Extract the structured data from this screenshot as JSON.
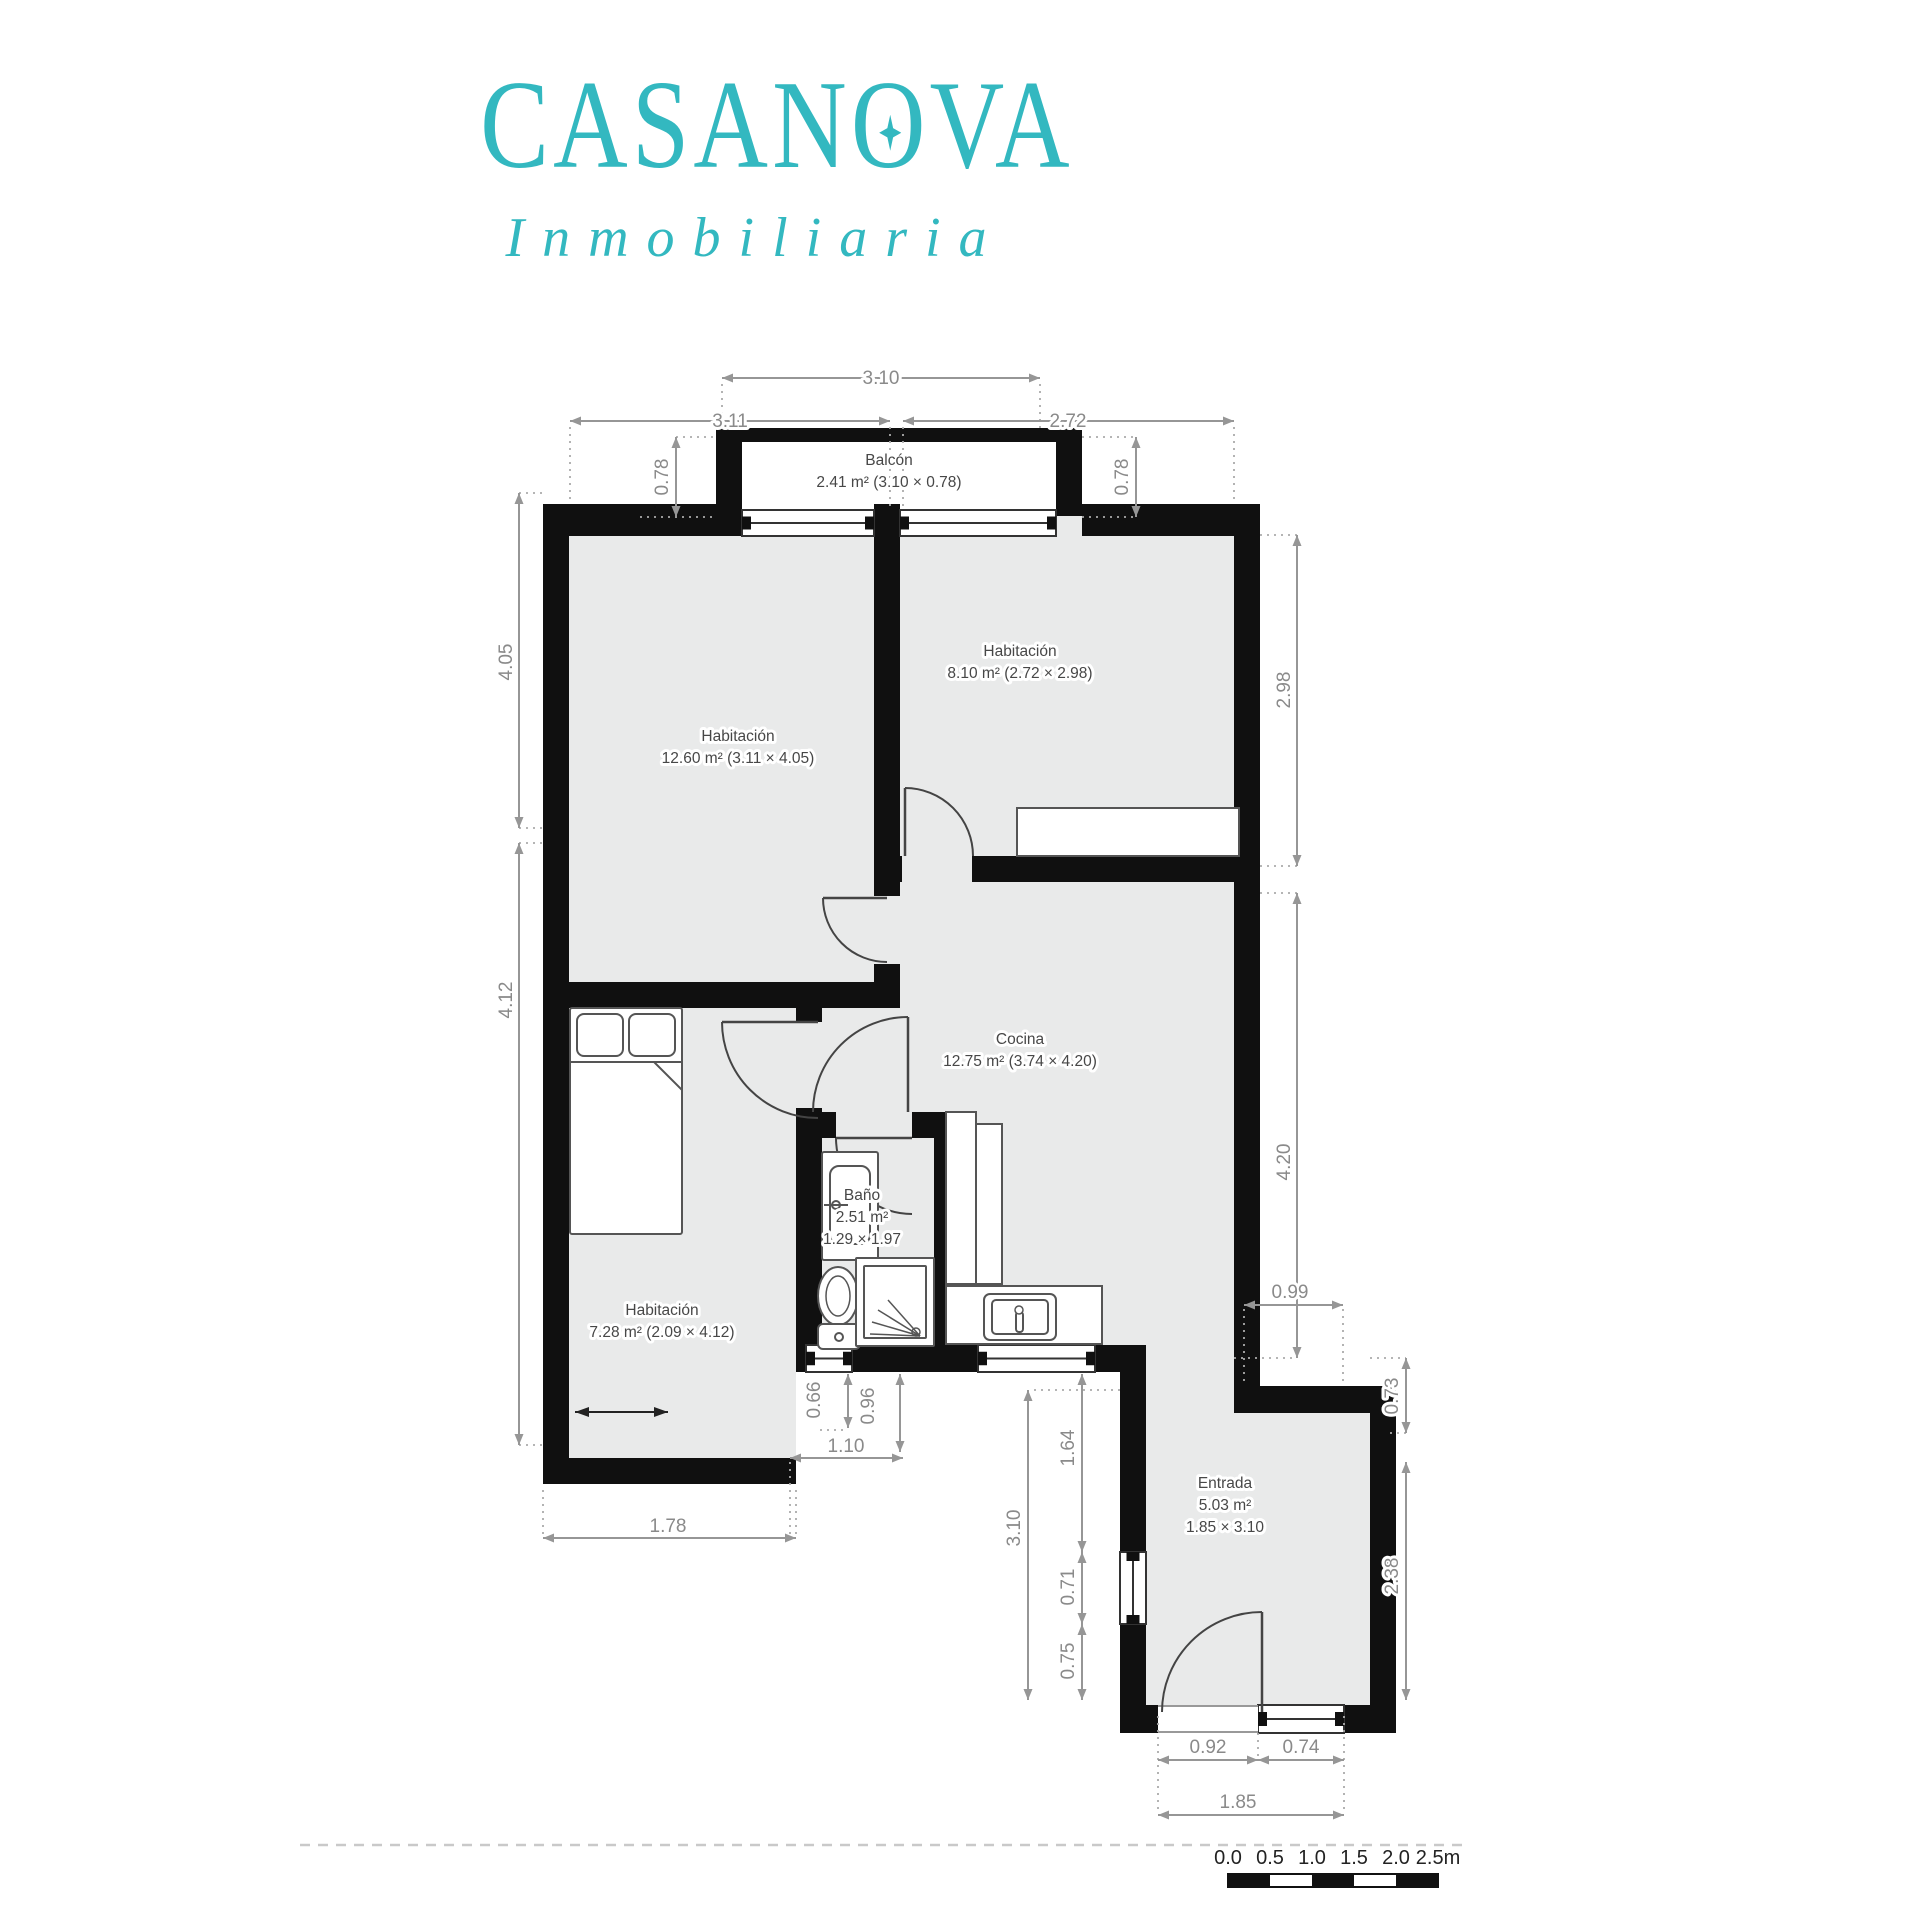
{
  "brand": {
    "name": "CASANOVA",
    "tagline": "Inmobiliaria",
    "accent_color": "#33b8c0"
  },
  "plan": {
    "rooms": [
      {
        "id": "balcon",
        "label": "Balcón",
        "area": "2.41 m² (3.10 × 0.78)",
        "cx": 889,
        "cy": 476
      },
      {
        "id": "hab1",
        "label": "Habitación",
        "area": "12.60 m² (3.11 × 4.05)",
        "cx": 738,
        "cy": 752
      },
      {
        "id": "hab2",
        "label": "Habitación",
        "area": "8.10 m² (2.72 × 2.98)",
        "cx": 1020,
        "cy": 667
      },
      {
        "id": "cocina",
        "label": "Cocina",
        "area": "12.75 m² (3.74 × 4.20)",
        "cx": 1020,
        "cy": 1055
      },
      {
        "id": "bano",
        "label": "Baño",
        "area": "2.51 m²",
        "area2": "1.29 × 1.97",
        "cx": 862,
        "cy": 1222
      },
      {
        "id": "hab3",
        "label": "Habitación",
        "area": "7.28 m² (2.09 × 4.12)",
        "cx": 662,
        "cy": 1326
      },
      {
        "id": "entrada",
        "label": "Entrada",
        "area": "5.03 m²",
        "area2": "1.85 × 3.10",
        "cx": 1225,
        "cy": 1510
      }
    ],
    "dimensions": [
      {
        "v": "3.10",
        "o": "h",
        "tx": 881,
        "ty": 384,
        "l": [
          722,
          378,
          1040,
          378
        ]
      },
      {
        "v": "3.11",
        "o": "h",
        "tx": 730,
        "ty": 427,
        "l": [
          570,
          421,
          890,
          421
        ]
      },
      {
        "v": "2.72",
        "o": "h",
        "tx": 1068,
        "ty": 427,
        "l": [
          903,
          421,
          1234,
          421
        ]
      },
      {
        "v": "0.78",
        "o": "v",
        "tx": 668,
        "ty": 477,
        "l": [
          676,
          437,
          676,
          517
        ]
      },
      {
        "v": "0.78",
        "o": "v",
        "tx": 1128,
        "ty": 477,
        "l": [
          1136,
          437,
          1136,
          517
        ]
      },
      {
        "v": "4.05",
        "o": "v",
        "tx": 512,
        "ty": 662,
        "l": [
          519,
          493,
          519,
          828
        ]
      },
      {
        "v": "4.12",
        "o": "v",
        "tx": 512,
        "ty": 1000,
        "l": [
          519,
          843,
          519,
          1445
        ]
      },
      {
        "v": "2.98",
        "o": "v",
        "tx": 1290,
        "ty": 690,
        "l": [
          1297,
          535,
          1297,
          866
        ]
      },
      {
        "v": "4.20",
        "o": "v",
        "tx": 1290,
        "ty": 1162,
        "l": [
          1297,
          893,
          1297,
          1358
        ]
      },
      {
        "v": "0.99",
        "o": "h",
        "tx": 1290,
        "ty": 1298,
        "l": [
          1244,
          1305,
          1343,
          1305
        ]
      },
      {
        "v": "0.73",
        "o": "v",
        "tx": 1398,
        "ty": 1396,
        "l": [
          1406,
          1358,
          1406,
          1433
        ]
      },
      {
        "v": "2.38",
        "o": "v",
        "tx": 1398,
        "ty": 1576,
        "l": [
          1406,
          1462,
          1406,
          1700
        ]
      },
      {
        "v": "0.66",
        "o": "v",
        "tx": 820,
        "ty": 1400,
        "l": [
          848,
          1374,
          848,
          1428
        ]
      },
      {
        "v": "0.96",
        "o": "v",
        "tx": 874,
        "ty": 1406,
        "l": [
          900,
          1374,
          900,
          1452
        ]
      },
      {
        "v": "1.10",
        "o": "h",
        "tx": 846,
        "ty": 1452,
        "l": [
          790,
          1458,
          903,
          1458
        ]
      },
      {
        "v": "1.78",
        "o": "h",
        "tx": 668,
        "ty": 1532,
        "l": [
          543,
          1538,
          796,
          1538
        ]
      },
      {
        "v": "3.10",
        "o": "v",
        "tx": 1020,
        "ty": 1528,
        "l": [
          1028,
          1390,
          1028,
          1700
        ]
      },
      {
        "v": "1.64",
        "o": "v",
        "tx": 1074,
        "ty": 1448,
        "l": [
          1082,
          1374,
          1082,
          1552
        ]
      },
      {
        "v": "0.71",
        "o": "v",
        "tx": 1074,
        "ty": 1587,
        "l": [
          1082,
          1552,
          1082,
          1624
        ]
      },
      {
        "v": "0.75",
        "o": "v",
        "tx": 1074,
        "ty": 1661,
        "l": [
          1082,
          1624,
          1082,
          1700
        ]
      },
      {
        "v": "0.92",
        "o": "h",
        "tx": 1208,
        "ty": 1753,
        "l": [
          1158,
          1760,
          1258,
          1760
        ]
      },
      {
        "v": "0.74",
        "o": "h",
        "tx": 1301,
        "ty": 1753,
        "l": [
          1258,
          1760,
          1344,
          1760
        ]
      },
      {
        "v": "1.85",
        "o": "h",
        "tx": 1238,
        "ty": 1808,
        "l": [
          1158,
          1815,
          1344,
          1815
        ]
      }
    ],
    "scalebar": {
      "labels": [
        "0.0",
        "0.5",
        "1.0",
        "1.5",
        "2.0",
        "2.5m"
      ]
    }
  }
}
